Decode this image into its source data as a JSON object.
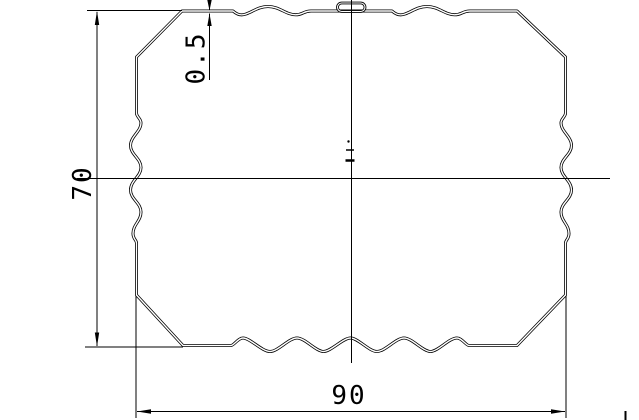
{
  "drawing": {
    "kind": "cross-section-profile",
    "dimensions": {
      "height": {
        "label": "70"
      },
      "width": {
        "label": "90"
      },
      "thickness": {
        "label": "0.5"
      }
    },
    "colors": {
      "line": "#000000",
      "background": "#ffffff"
    }
  }
}
